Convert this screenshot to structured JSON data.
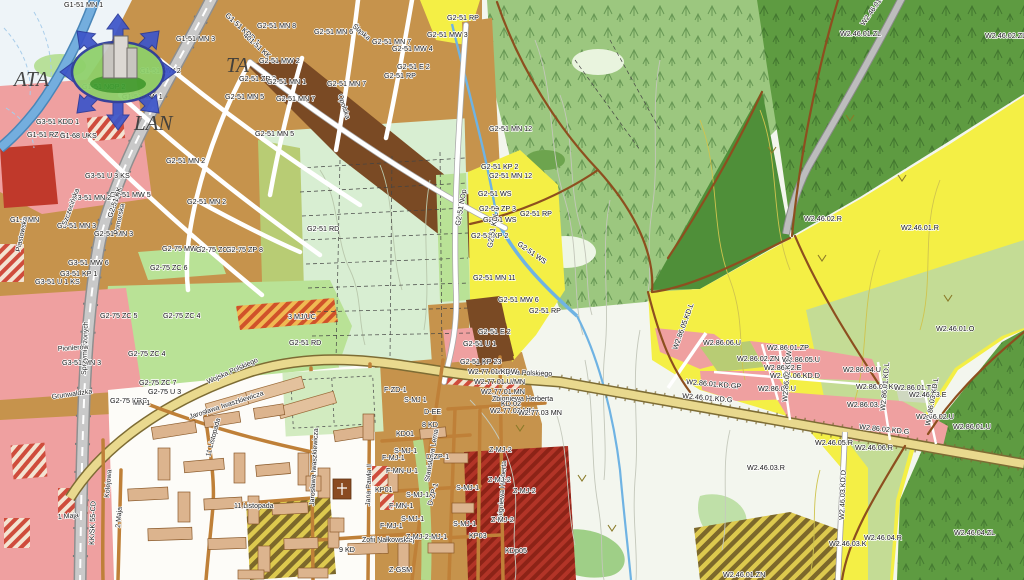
{
  "watermark": {
    "left": "ATA",
    "right": "TA",
    "bottom": "LAN"
  },
  "palette": {
    "urban_residential": "#c6934c",
    "dark_brown_mw": "#7a4a24",
    "services_pink": "#efa0a0",
    "services_red": "#c0392b",
    "park_green": "#b9e296",
    "field_mint": "#d8eed2",
    "farmland_olive": "#b8cc74",
    "forest_green": "#9cc77f",
    "forest_dark": "#5e9b41",
    "forest_darker": "#4f8f39",
    "crops_yellow": "#f4ef45",
    "orchard_olive": "#c4dc95",
    "valley_pale": "#f3f6ee",
    "water_blue": "#74aede",
    "main_road_fill": "#e9d98e",
    "railway_gray": "#c9c9c9",
    "town_white": "#fdfcf8",
    "building_tan": "#dcb48e"
  },
  "map_labels": [
    {
      "t": "G1-51 MN 1",
      "x": 64,
      "y": 7
    },
    {
      "t": "G1-51 MN 3",
      "x": 176,
      "y": 41
    },
    {
      "t": "G1-51 MW 2",
      "x": 140,
      "y": 73
    },
    {
      "t": "G1-51 NOP 2",
      "x": 82,
      "y": 89
    },
    {
      "t": "G1-51 MW 1",
      "x": 122,
      "y": 99
    },
    {
      "t": "G1-51 RZ 2",
      "x": 27,
      "y": 137
    },
    {
      "t": "G1-68 UKS",
      "x": 60,
      "y": 138
    },
    {
      "t": "G1-51 KDD 1",
      "x": 225,
      "y": 16,
      "r": 42
    },
    {
      "t": "401-51 KK",
      "x": 243,
      "y": 36,
      "r": 42
    },
    {
      "t": "G2-51 MN 8",
      "x": 257,
      "y": 28
    },
    {
      "t": "G2-51 MN 6",
      "x": 314,
      "y": 34
    },
    {
      "t": "G2-51 MN 7",
      "x": 372,
      "y": 44
    },
    {
      "t": "G2-51 MW 4",
      "x": 392,
      "y": 51
    },
    {
      "t": "G2-51 MW 3",
      "x": 427,
      "y": 37
    },
    {
      "t": "G2-51 RP",
      "x": 447,
      "y": 20
    },
    {
      "t": "G2-51 MW 2",
      "x": 259,
      "y": 63
    },
    {
      "t": "G2-51 ZP 2",
      "x": 239,
      "y": 81
    },
    {
      "t": "G2-51 MN 1",
      "x": 267,
      "y": 84
    },
    {
      "t": "G2-51 MN 5",
      "x": 225,
      "y": 99
    },
    {
      "t": "G2-51 MN 7",
      "x": 276,
      "y": 101
    },
    {
      "t": "G2-51 MN 7",
      "x": 327,
      "y": 86
    },
    {
      "t": "G2-51 MN 5",
      "x": 255,
      "y": 136
    },
    {
      "t": "G2-51 E 2",
      "x": 397,
      "y": 69
    },
    {
      "t": "G2-51 RP",
      "x": 384,
      "y": 78
    },
    {
      "t": "G2-51 MN 2",
      "x": 166,
      "y": 163
    },
    {
      "t": "G2-51 MN 2",
      "x": 187,
      "y": 204
    },
    {
      "t": "G2-51 MN 3",
      "x": 94,
      "y": 236
    },
    {
      "t": "G3-51 MN 3",
      "x": 57,
      "y": 228
    },
    {
      "t": "G3-51 U 3 KS",
      "x": 85,
      "y": 178
    },
    {
      "t": "G3-51 MW 5",
      "x": 110,
      "y": 197
    },
    {
      "t": "G3-51 MN 2",
      "x": 72,
      "y": 200
    },
    {
      "t": "G3-51 KDD 1",
      "x": 36,
      "y": 124
    },
    {
      "t": "G2-51 KK",
      "x": 112,
      "y": 218,
      "r": -72
    },
    {
      "t": "G1-2 MN",
      "x": 10,
      "y": 222
    },
    {
      "t": "G3-51 MW 6",
      "x": 68,
      "y": 265
    },
    {
      "t": "G3-51 KP 1",
      "x": 60,
      "y": 276
    },
    {
      "t": "G3-51 U 1 KS",
      "x": 35,
      "y": 284
    },
    {
      "t": "G2-75 MW 2",
      "x": 162,
      "y": 251
    },
    {
      "t": "G2-75 ZC 6",
      "x": 196,
      "y": 252
    },
    {
      "t": "G2-75 ZP 8",
      "x": 226,
      "y": 252
    },
    {
      "t": "G2-75 ZC 6",
      "x": 150,
      "y": 270
    },
    {
      "t": "G2-75 ZC 5",
      "x": 100,
      "y": 318
    },
    {
      "t": "G2-75 ZC 4",
      "x": 163,
      "y": 318
    },
    {
      "t": "G2-75 ZC 4",
      "x": 128,
      "y": 356
    },
    {
      "t": "G3-51 MN 3",
      "x": 62,
      "y": 365
    },
    {
      "t": "G2-75 ZC 7",
      "x": 139,
      "y": 385
    },
    {
      "t": "G2-75 U 3",
      "x": 148,
      "y": 394
    },
    {
      "t": "G2-75 KDG",
      "x": 110,
      "y": 403
    },
    {
      "t": "MN 1",
      "x": 133,
      "y": 405
    },
    {
      "t": "Śląska",
      "x": 352,
      "y": 27,
      "r": 40,
      "c": "street"
    },
    {
      "t": "Opolska",
      "x": 338,
      "y": 95,
      "r": 72,
      "c": "street"
    },
    {
      "t": "Piastowska",
      "x": 20,
      "y": 252,
      "r": -78,
      "c": "street"
    },
    {
      "t": "Szczecińska",
      "x": 66,
      "y": 226,
      "r": -70,
      "c": "street"
    },
    {
      "t": "Pomorska",
      "x": 118,
      "y": 235,
      "r": -78,
      "c": "street"
    },
    {
      "t": "Sprzymierzonych",
      "x": 86,
      "y": 375,
      "r": -88,
      "c": "street"
    },
    {
      "t": "Grunwaldzka",
      "x": 52,
      "y": 399,
      "r": -8,
      "c": "street"
    },
    {
      "t": "Pionierów",
      "x": 58,
      "y": 351,
      "r": -4,
      "c": "street"
    },
    {
      "t": "1 Maja",
      "x": 58,
      "y": 519,
      "r": -5,
      "c": "street"
    },
    {
      "t": "2 Maja",
      "x": 120,
      "y": 528,
      "r": -85,
      "c": "street"
    },
    {
      "t": "Kolejowa",
      "x": 109,
      "y": 498,
      "r": -85,
      "c": "street"
    },
    {
      "t": "KK/SK 55-CD",
      "x": 94,
      "y": 545,
      "r": -88
    },
    {
      "t": "Wojska Polskiego",
      "x": 208,
      "y": 384,
      "r": -24,
      "c": "street"
    },
    {
      "t": "Wojska Polskiego",
      "x": 497,
      "y": 374,
      "r": 2,
      "c": "street"
    },
    {
      "t": "Jarosława Iwaszkiewicza",
      "x": 190,
      "y": 419,
      "r": -18,
      "c": "street"
    },
    {
      "t": "Jarosława Iwaszkiewicza",
      "x": 314,
      "y": 506,
      "r": -87,
      "c": "street"
    },
    {
      "t": "11 Listopada",
      "x": 234,
      "y": 508,
      "c": "street"
    },
    {
      "t": "11 Listopada",
      "x": 210,
      "y": 457,
      "r": -75,
      "c": "street"
    },
    {
      "t": "Zofii Nałkowskiej",
      "x": 362,
      "y": 542,
      "c": "street"
    },
    {
      "t": "9 KD",
      "x": 339,
      "y": 552
    },
    {
      "t": "Jana Pawła II",
      "x": 370,
      "y": 506,
      "r": -88,
      "c": "street"
    },
    {
      "t": "Stanisława Lema",
      "x": 429,
      "y": 482,
      "r": -80,
      "c": "street"
    },
    {
      "t": "Zbigniewa Herberta",
      "x": 492,
      "y": 401,
      "c": "street"
    },
    {
      "t": "Zbigniewa Herberta",
      "x": 502,
      "y": 522,
      "r": -86,
      "c": "street"
    },
    {
      "t": "F-ZD-1",
      "x": 384,
      "y": 392
    },
    {
      "t": "KD01",
      "x": 396,
      "y": 436
    },
    {
      "t": "S-MJ 1",
      "x": 404,
      "y": 402
    },
    {
      "t": "D-EE",
      "x": 424,
      "y": 414
    },
    {
      "t": "8 KD",
      "x": 422,
      "y": 427
    },
    {
      "t": "S-MJ-1",
      "x": 394,
      "y": 453
    },
    {
      "t": "F-MJ-1",
      "x": 382,
      "y": 460
    },
    {
      "t": "F-MN-U-1",
      "x": 386,
      "y": 473
    },
    {
      "t": "KP01",
      "x": 375,
      "y": 492
    },
    {
      "t": "S-MJ-1",
      "x": 406,
      "y": 497
    },
    {
      "t": "F-MN-1",
      "x": 389,
      "y": 508
    },
    {
      "t": "F-MJ-1",
      "x": 380,
      "y": 528
    },
    {
      "t": "Z-MJ-2-MJ-1",
      "x": 406,
      "y": 539
    },
    {
      "t": "S-MJ-1",
      "x": 456,
      "y": 490
    },
    {
      "t": "S-MJ-1",
      "x": 401,
      "y": 521
    },
    {
      "t": "S-MJ-1",
      "x": 453,
      "y": 526
    },
    {
      "t": "Z-MJ-2",
      "x": 489,
      "y": 452
    },
    {
      "t": "Z-MJ-2",
      "x": 488,
      "y": 482
    },
    {
      "t": "Z-MJ-2",
      "x": 513,
      "y": 493
    },
    {
      "t": "Z-MJ-2",
      "x": 491,
      "y": 522
    },
    {
      "t": "KP03",
      "x": 469,
      "y": 538
    },
    {
      "t": "KDp05",
      "x": 505,
      "y": 553
    },
    {
      "t": "Z-GSM",
      "x": 389,
      "y": 572
    },
    {
      "t": "D-ZP-1",
      "x": 426,
      "y": 459
    },
    {
      "t": "D-ZP-1",
      "x": 432,
      "y": 506,
      "r": -75
    },
    {
      "t": "G2-51 MN 12",
      "x": 489,
      "y": 131
    },
    {
      "t": "G2-51 KP 2",
      "x": 481,
      "y": 169
    },
    {
      "t": "G2-51 MN 12",
      "x": 489,
      "y": 178
    },
    {
      "t": "G2-51 WS",
      "x": 478,
      "y": 196
    },
    {
      "t": "G2-51 ZP 3",
      "x": 479,
      "y": 211
    },
    {
      "t": "G2-51 WS",
      "x": 483,
      "y": 222
    },
    {
      "t": "G2-51 KP 2",
      "x": 471,
      "y": 238
    },
    {
      "t": "G2-51 NOp",
      "x": 460,
      "y": 226,
      "r": -80
    },
    {
      "t": "G2-51 KDL 1",
      "x": 492,
      "y": 248,
      "r": -80
    },
    {
      "t": "G2-51 MN 11",
      "x": 473,
      "y": 280
    },
    {
      "t": "G2-51 MW 6",
      "x": 498,
      "y": 302
    },
    {
      "t": "G2-51 RP",
      "x": 520,
      "y": 216
    },
    {
      "t": "G2-51 RP",
      "x": 529,
      "y": 313
    },
    {
      "t": "G2-51 WS",
      "x": 517,
      "y": 245,
      "r": 35
    },
    {
      "t": "G2-51 E 2",
      "x": 478,
      "y": 334
    },
    {
      "t": "G2-51 U 1",
      "x": 463,
      "y": 346
    },
    {
      "t": "G2-51 KP 23",
      "x": 460,
      "y": 364
    },
    {
      "t": "W2.77.01.KDW",
      "x": 468,
      "y": 374
    },
    {
      "t": "W2.77.01.U/MN",
      "x": 474,
      "y": 384
    },
    {
      "t": "W2.77.01.MN",
      "x": 481,
      "y": 394
    },
    {
      "t": "KD.02",
      "x": 501,
      "y": 406
    },
    {
      "t": "W2.77.02 MN",
      "x": 490,
      "y": 413
    },
    {
      "t": "W2.77.03 MN",
      "x": 518,
      "y": 415
    },
    {
      "t": "G2-51 RD",
      "x": 307,
      "y": 231
    },
    {
      "t": "G2-51 RD",
      "x": 289,
      "y": 345
    },
    {
      "t": "3 MJ/UC",
      "x": 288,
      "y": 319
    },
    {
      "t": "W2.46.01.ZL",
      "x": 840,
      "y": 36
    },
    {
      "t": "W2.46.01.E",
      "x": 864,
      "y": 26,
      "r": -55
    },
    {
      "t": "W2.46.02.ZL",
      "x": 985,
      "y": 38
    },
    {
      "t": "W2.46.02.R",
      "x": 804,
      "y": 221
    },
    {
      "t": "W2.46.01.R",
      "x": 901,
      "y": 230
    },
    {
      "t": "W2.46.01.O",
      "x": 936,
      "y": 331
    },
    {
      "t": "W2.86.06.U",
      "x": 703,
      "y": 345
    },
    {
      "t": "W2.86.01.ZP",
      "x": 767,
      "y": 350
    },
    {
      "t": "W2.86.02.ZN",
      "x": 737,
      "y": 361
    },
    {
      "t": "W2.86.05.U",
      "x": 782,
      "y": 362
    },
    {
      "t": "W2.86.02.E",
      "x": 764,
      "y": 370
    },
    {
      "t": "W2.86.06.KD.D",
      "x": 770,
      "y": 378
    },
    {
      "t": "W2.86.04.U",
      "x": 843,
      "y": 372
    },
    {
      "t": "W2.86.07.U",
      "x": 758,
      "y": 391
    },
    {
      "t": "W2.86.04.KD",
      "x": 856,
      "y": 389
    },
    {
      "t": "W2.86.01.TK",
      "x": 894,
      "y": 390
    },
    {
      "t": "W2.46.03.E",
      "x": 909,
      "y": 397
    },
    {
      "t": "W2.86.03.U",
      "x": 847,
      "y": 407
    },
    {
      "t": "W2.86.02.U",
      "x": 916,
      "y": 419
    },
    {
      "t": "W2.86.01.U",
      "x": 953,
      "y": 429
    },
    {
      "t": "W2.86.02.KD.G",
      "x": 859,
      "y": 429,
      "r": 6
    },
    {
      "t": "W2.46.01.KD.G",
      "x": 682,
      "y": 398,
      "r": 5
    },
    {
      "t": "W2.86.01.KD.GP",
      "x": 686,
      "y": 384,
      "r": 5
    },
    {
      "t": "W2.86.05.KD.L",
      "x": 677,
      "y": 350,
      "r": -70
    },
    {
      "t": "W2.86.02.KD.W",
      "x": 787,
      "y": 402,
      "r": -85
    },
    {
      "t": "W2.86.01.KD.L",
      "x": 885,
      "y": 411,
      "r": -85
    },
    {
      "t": "W2.86.03.KD.L",
      "x": 930,
      "y": 426,
      "r": -80
    },
    {
      "t": "W2.46.05.R",
      "x": 815,
      "y": 445
    },
    {
      "t": "W2.46.06.R",
      "x": 855,
      "y": 450
    },
    {
      "t": "W2.46.03.R",
      "x": 747,
      "y": 470
    },
    {
      "t": "W2.46.04.R",
      "x": 864,
      "y": 540
    },
    {
      "t": "W2.46.03.K",
      "x": 829,
      "y": 546
    },
    {
      "t": "W2.46.03.KD.D",
      "x": 844,
      "y": 520,
      "r": -88
    },
    {
      "t": "W2.46.04.ZL",
      "x": 954,
      "y": 535
    },
    {
      "t": "W2.46.01.ZN",
      "x": 723,
      "y": 577
    }
  ]
}
